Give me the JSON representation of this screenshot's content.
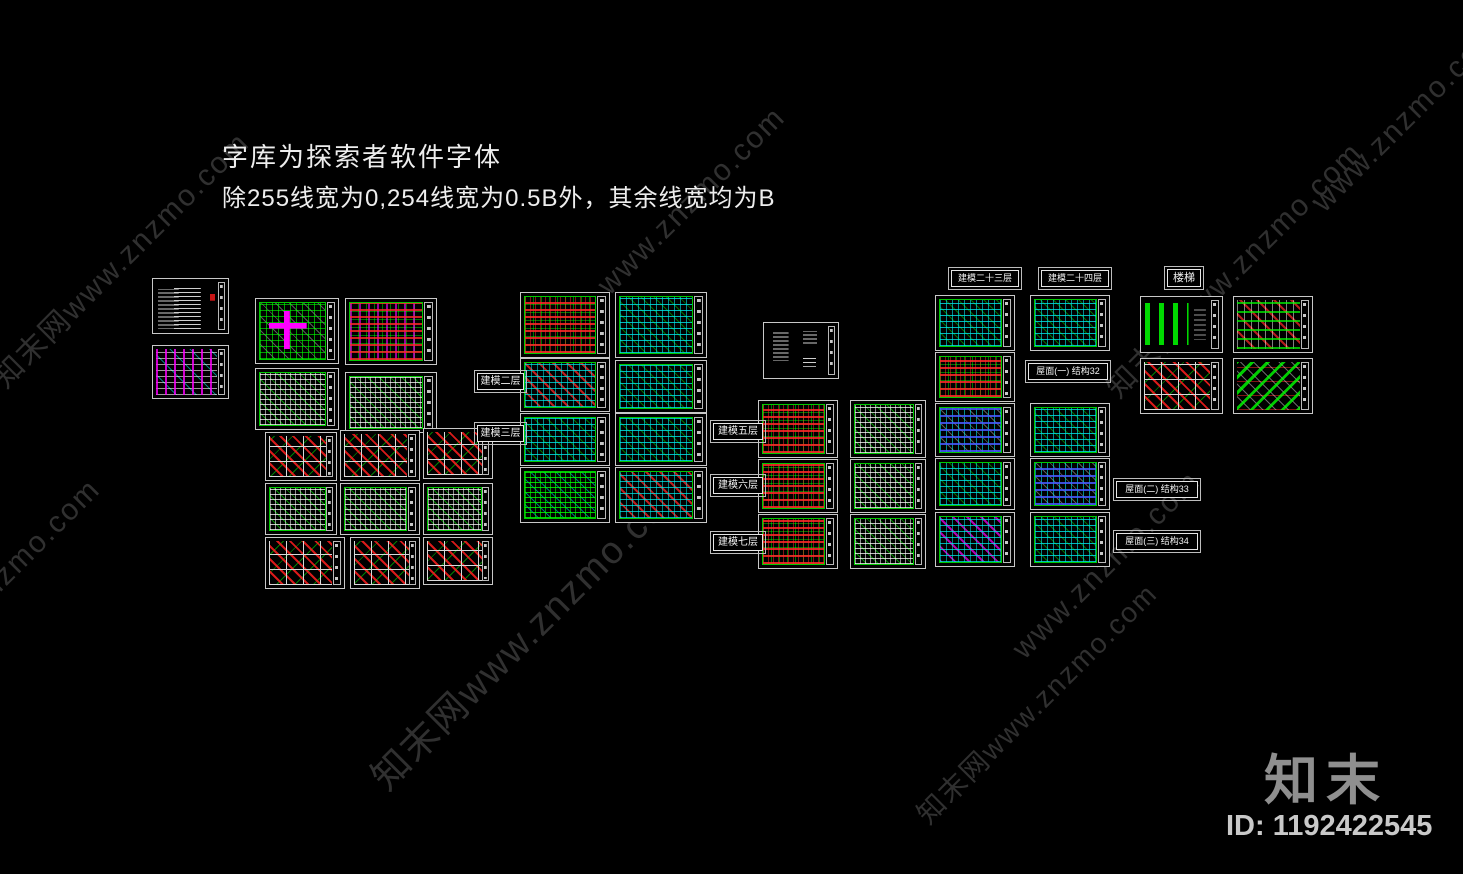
{
  "note": {
    "line1": "字库为探索者软件字体",
    "line2": "除255线宽为0,254线宽为0.5B外，其余线宽均为B"
  },
  "watermark": {
    "text_full": "知末网www.znzmo.com",
    "text_short": "www.znzmo.com",
    "color": "#303030",
    "instances": [
      {
        "x": 12,
        "y": 352,
        "variant": "full",
        "size": 30
      },
      {
        "x": 615,
        "y": 268,
        "variant": "short",
        "size": 30
      },
      {
        "x": 1125,
        "y": 362,
        "variant": "full",
        "size": 30
      },
      {
        "x": -70,
        "y": 640,
        "variant": "short",
        "size": 30
      },
      {
        "x": 395,
        "y": 745,
        "variant": "full",
        "size": 38
      },
      {
        "x": 1030,
        "y": 632,
        "variant": "short",
        "size": 30
      },
      {
        "x": 935,
        "y": 792,
        "variant": "full",
        "size": 28
      },
      {
        "x": 1330,
        "y": 185,
        "variant": "short",
        "size": 30
      }
    ]
  },
  "branding": {
    "logo_text": "知末",
    "id_text": "ID: 1192422545",
    "logo_color": "#8f8f8f",
    "id_color": "#c9c9c9"
  },
  "palette": {
    "background": "#000000",
    "sheet_border": "#c8c8c8",
    "cad_green": "#00ff00",
    "cad_cyan": "#00ffff",
    "cad_red": "#ff2020",
    "cad_magenta": "#ff00ff",
    "cad_white": "#d9d9d9",
    "note_text": "#ededed"
  },
  "labels": [
    {
      "text": "建模二层",
      "x": 477,
      "y": 373,
      "w": 47,
      "h": 17,
      "fs": 10
    },
    {
      "text": "建模三层",
      "x": 477,
      "y": 425,
      "w": 47,
      "h": 17,
      "fs": 10
    },
    {
      "text": "建模五层",
      "x": 713,
      "y": 423,
      "w": 50,
      "h": 17,
      "fs": 10
    },
    {
      "text": "建模六层",
      "x": 713,
      "y": 477,
      "w": 50,
      "h": 17,
      "fs": 10
    },
    {
      "text": "建模七层",
      "x": 713,
      "y": 534,
      "w": 50,
      "h": 17,
      "fs": 10
    },
    {
      "text": "建模二十三层",
      "x": 951,
      "y": 270,
      "w": 68,
      "h": 17,
      "fs": 9
    },
    {
      "text": "建模二十四层",
      "x": 1041,
      "y": 270,
      "w": 68,
      "h": 17,
      "fs": 9
    },
    {
      "text": "屋面(一) 结构32",
      "x": 1028,
      "y": 363,
      "w": 80,
      "h": 17,
      "fs": 9
    },
    {
      "text": "屋面(二) 结构33",
      "x": 1116,
      "y": 481,
      "w": 82,
      "h": 17,
      "fs": 9
    },
    {
      "text": "屋面(三) 结构34",
      "x": 1116,
      "y": 533,
      "w": 82,
      "h": 17,
      "fs": 9
    },
    {
      "text": "楼梯",
      "x": 1167,
      "y": 269,
      "w": 34,
      "h": 18,
      "fs": 11
    }
  ],
  "sheets": [
    {
      "id": "s01",
      "kind": "text-list",
      "x": 152,
      "y": 278,
      "w": 77,
      "h": 56
    },
    {
      "id": "s02",
      "kind": "magenta-details",
      "x": 152,
      "y": 345,
      "w": 77,
      "h": 54
    },
    {
      "id": "s03",
      "kind": "plan-green-magenta",
      "x": 255,
      "y": 298,
      "w": 84,
      "h": 66
    },
    {
      "id": "s04",
      "kind": "plan-red-magenta",
      "x": 345,
      "y": 298,
      "w": 92,
      "h": 67
    },
    {
      "id": "s05",
      "kind": "plan-green",
      "x": 255,
      "y": 368,
      "w": 84,
      "h": 62
    },
    {
      "id": "s06",
      "kind": "plan-green",
      "x": 345,
      "y": 372,
      "w": 92,
      "h": 61
    },
    {
      "id": "s07",
      "kind": "details-red",
      "x": 265,
      "y": 432,
      "w": 72,
      "h": 49
    },
    {
      "id": "s08",
      "kind": "details-red",
      "x": 340,
      "y": 430,
      "w": 80,
      "h": 51
    },
    {
      "id": "s09",
      "kind": "details-red",
      "x": 423,
      "y": 428,
      "w": 70,
      "h": 51
    },
    {
      "id": "s10",
      "kind": "plan-green",
      "x": 265,
      "y": 483,
      "w": 72,
      "h": 52
    },
    {
      "id": "s11",
      "kind": "plan-green",
      "x": 340,
      "y": 483,
      "w": 80,
      "h": 52
    },
    {
      "id": "s12",
      "kind": "plan-green",
      "x": 423,
      "y": 483,
      "w": 70,
      "h": 52
    },
    {
      "id": "s13",
      "kind": "details-red",
      "x": 265,
      "y": 537,
      "w": 80,
      "h": 52
    },
    {
      "id": "s14",
      "kind": "details-red",
      "x": 350,
      "y": 537,
      "w": 70,
      "h": 52
    },
    {
      "id": "s15",
      "kind": "details-red",
      "x": 423,
      "y": 537,
      "w": 70,
      "h": 48
    },
    {
      "id": "m1",
      "kind": "plan-red",
      "x": 520,
      "y": 292,
      "w": 90,
      "h": 66
    },
    {
      "id": "m2",
      "kind": "plan-cyan",
      "x": 615,
      "y": 292,
      "w": 92,
      "h": 66
    },
    {
      "id": "m3",
      "kind": "plan-cyan-red",
      "x": 520,
      "y": 358,
      "w": 90,
      "h": 54
    },
    {
      "id": "m4",
      "kind": "plan-cyan",
      "x": 615,
      "y": 360,
      "w": 92,
      "h": 53
    },
    {
      "id": "m5",
      "kind": "plan-cyan",
      "x": 520,
      "y": 413,
      "w": 90,
      "h": 53
    },
    {
      "id": "m6",
      "kind": "plan-cyan",
      "x": 615,
      "y": 413,
      "w": 92,
      "h": 53
    },
    {
      "id": "m7",
      "kind": "plan-green-dense",
      "x": 520,
      "y": 467,
      "w": 90,
      "h": 56
    },
    {
      "id": "m8",
      "kind": "plan-cyan-red",
      "x": 615,
      "y": 467,
      "w": 92,
      "h": 56
    },
    {
      "id": "n1",
      "kind": "notes-text",
      "x": 763,
      "y": 322,
      "w": 76,
      "h": 57
    },
    {
      "id": "r1",
      "kind": "plan-red",
      "x": 758,
      "y": 400,
      "w": 80,
      "h": 58
    },
    {
      "id": "r2",
      "kind": "plan-green",
      "x": 850,
      "y": 400,
      "w": 76,
      "h": 58
    },
    {
      "id": "r3",
      "kind": "plan-red",
      "x": 758,
      "y": 459,
      "w": 80,
      "h": 54
    },
    {
      "id": "r4",
      "kind": "plan-green",
      "x": 850,
      "y": 459,
      "w": 76,
      "h": 54
    },
    {
      "id": "r5",
      "kind": "plan-red",
      "x": 758,
      "y": 514,
      "w": 80,
      "h": 55
    },
    {
      "id": "r6",
      "kind": "plan-green",
      "x": 850,
      "y": 514,
      "w": 76,
      "h": 55
    },
    {
      "id": "a1",
      "kind": "plan-cyan",
      "x": 935,
      "y": 295,
      "w": 80,
      "h": 56
    },
    {
      "id": "a2",
      "kind": "plan-red",
      "x": 935,
      "y": 352,
      "w": 80,
      "h": 50
    },
    {
      "id": "a3",
      "kind": "plan-blue-cyan",
      "x": 935,
      "y": 403,
      "w": 80,
      "h": 54
    },
    {
      "id": "a4",
      "kind": "plan-cyan",
      "x": 935,
      "y": 458,
      "w": 80,
      "h": 52
    },
    {
      "id": "a5",
      "kind": "plan-cyan-magenta",
      "x": 935,
      "y": 512,
      "w": 80,
      "h": 55
    },
    {
      "id": "b1",
      "kind": "plan-cyan",
      "x": 1030,
      "y": 295,
      "w": 80,
      "h": 56
    },
    {
      "id": "b3",
      "kind": "plan-cyan",
      "x": 1030,
      "y": 403,
      "w": 80,
      "h": 54
    },
    {
      "id": "b4",
      "kind": "plan-blue-cyan",
      "x": 1030,
      "y": 458,
      "w": 80,
      "h": 52
    },
    {
      "id": "b5",
      "kind": "plan-cyan",
      "x": 1030,
      "y": 512,
      "w": 80,
      "h": 55
    },
    {
      "id": "f1",
      "kind": "stairs-strips",
      "x": 1140,
      "y": 296,
      "w": 83,
      "h": 57
    },
    {
      "id": "f2",
      "kind": "stairs-details",
      "x": 1233,
      "y": 296,
      "w": 80,
      "h": 57
    },
    {
      "id": "f3",
      "kind": "details-red",
      "x": 1140,
      "y": 358,
      "w": 83,
      "h": 56
    },
    {
      "id": "f4",
      "kind": "stairs-green",
      "x": 1233,
      "y": 358,
      "w": 80,
      "h": 56
    }
  ]
}
